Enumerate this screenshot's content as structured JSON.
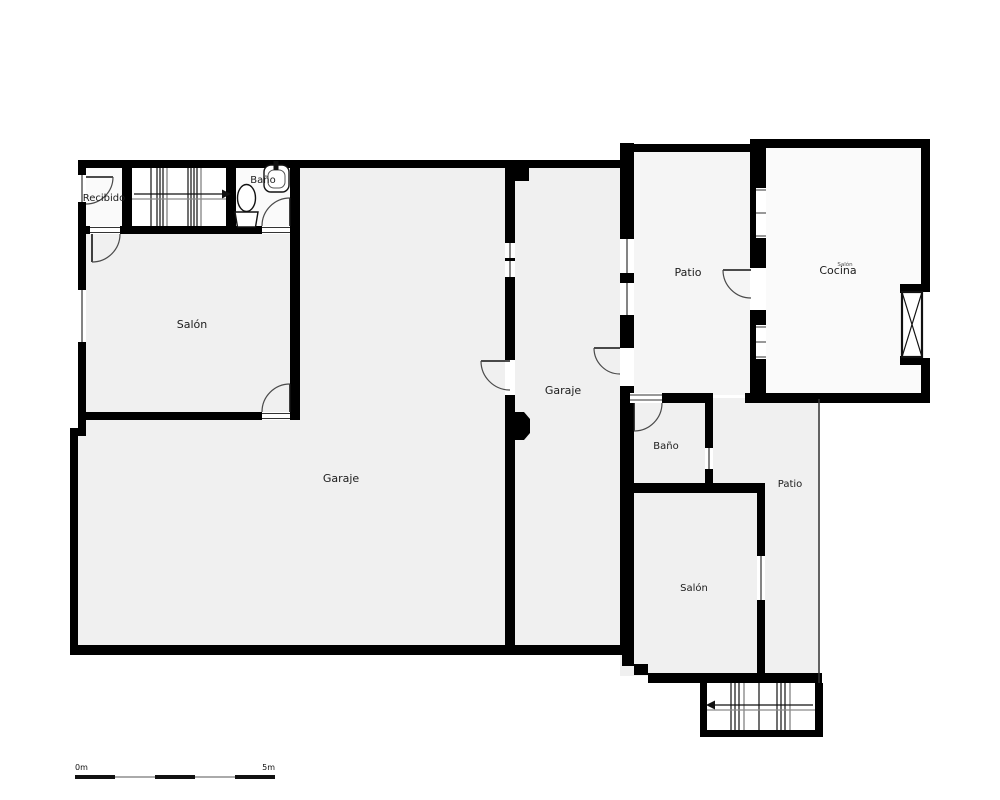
{
  "plan": {
    "type": "floor-plan",
    "rooms": [
      {
        "id": "recibido",
        "label": "Recibido"
      },
      {
        "id": "bano-top",
        "label": "Baño"
      },
      {
        "id": "salon-top",
        "label": "Salón"
      },
      {
        "id": "garaje-main",
        "label": "Garaje"
      },
      {
        "id": "garaje-second",
        "label": "Garaje"
      },
      {
        "id": "patio-top",
        "label": "Patio"
      },
      {
        "id": "cocina",
        "label": "Cocina"
      },
      {
        "id": "cocina-tiny-overlay",
        "label": "Salón"
      },
      {
        "id": "bano-right",
        "label": "Baño"
      },
      {
        "id": "patio-right",
        "label": "Patio"
      },
      {
        "id": "salon-bottom",
        "label": "Salón"
      }
    ],
    "fixtures": [
      "toilet-icon",
      "sink-icon",
      "stairs-up-arrow-right",
      "stairs-down-arrow-left",
      "x-window"
    ],
    "scale_bar": {
      "start_label": "0m",
      "end_label": "5m"
    },
    "colors": {
      "wall": "#000000",
      "room_fill": "#f0f0f0",
      "light_room_fill": "#fafafa",
      "patio_fill": "#f5f5f5",
      "door_stroke": "#4a4a4a",
      "scale_gray": "#aaaaaa",
      "scale_black": "#111111"
    }
  }
}
